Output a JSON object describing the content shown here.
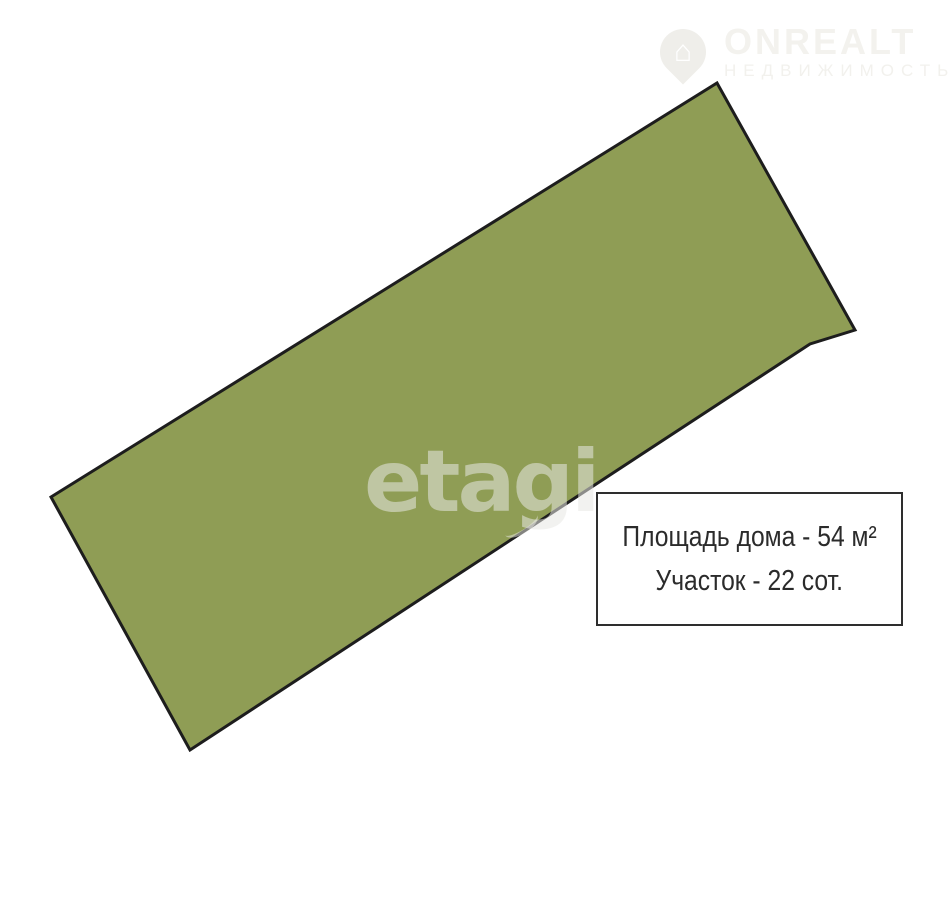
{
  "page": {
    "background_color": "#ffffff"
  },
  "logo": {
    "title": "ONREALT",
    "subtitle": "НЕДВИЖИМОСТЬ",
    "color": "#f3f2ee",
    "pin_icon": "map-pin-house-icon",
    "house_glyph": "⌂"
  },
  "plot": {
    "polygon_points": "717,83 855,330 810,344 190,750 51,497",
    "fill_color": "#8f9d55",
    "stroke_color": "#1d1d1d",
    "stroke_width": "3"
  },
  "watermark": {
    "text": "etagi"
  },
  "info_box": {
    "house_area": "Площадь дома - 54 м²",
    "land_area": "Участок - 22 сот."
  }
}
